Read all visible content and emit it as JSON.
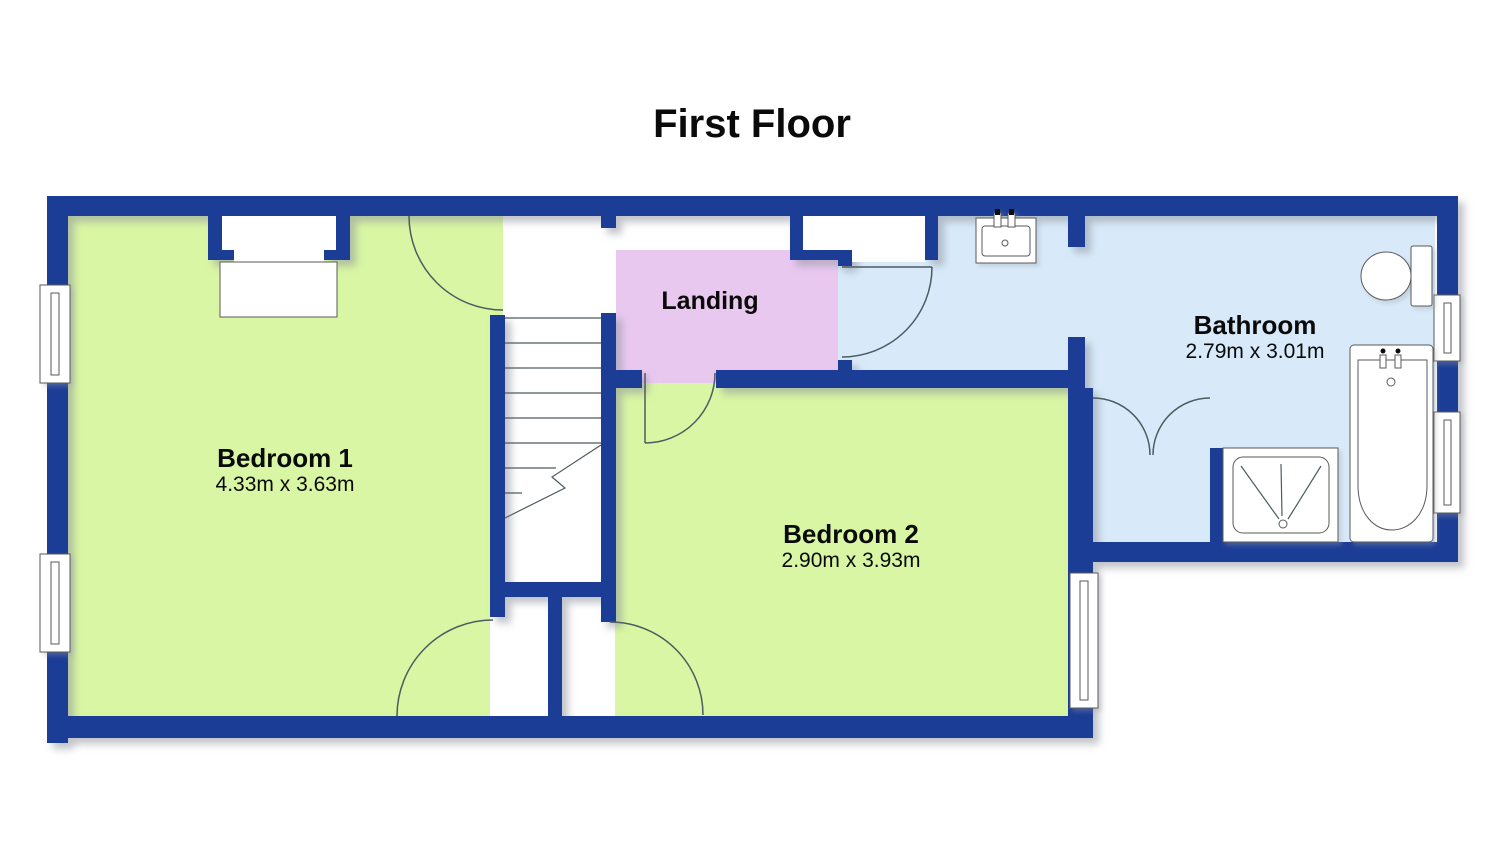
{
  "title": "First Floor",
  "rooms": {
    "bedroom1": {
      "name": "Bedroom 1",
      "dims": "4.33m x 3.63m"
    },
    "bedroom2": {
      "name": "Bedroom 2",
      "dims": "2.90m x 3.93m"
    },
    "bathroom": {
      "name": "Bathroom",
      "dims": "2.79m x 3.01m"
    },
    "landing": {
      "name": "Landing"
    }
  },
  "fixtures": {
    "stairs": "staircase",
    "sink": "wash-basin",
    "toilet": "toilet",
    "bathtub": "bathtub",
    "shower": "shower-tray",
    "cupboard": "double-door-cupboard",
    "wardrobe": "wardrobe",
    "windows": 5,
    "door_arcs": 5
  },
  "colors": {
    "wall": "#1e3d96",
    "bedroom": "#d8f6a3",
    "landing": "#e9c8f0",
    "bathroom": "#d8eafa",
    "line": "#4e5b60",
    "fixture": "#5a5a5a",
    "text": "#0a0a0a",
    "background": "#ffffff"
  }
}
